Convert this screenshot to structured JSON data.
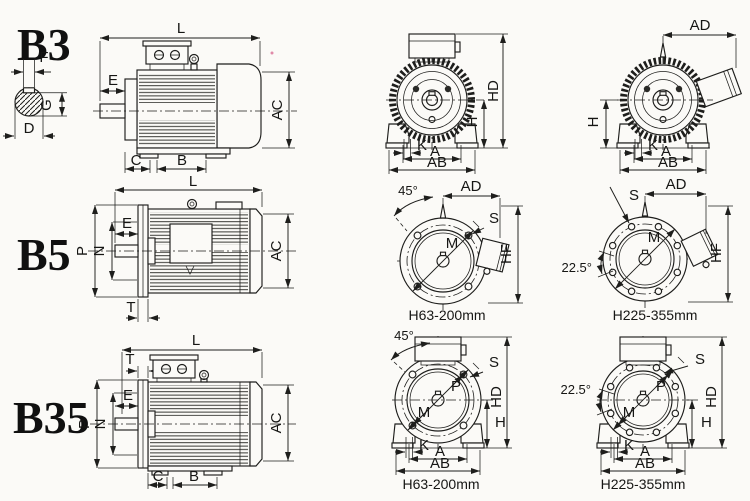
{
  "page": {
    "description": "IEC motor mounting arrangement dimension drawings",
    "background": "#fbfaf7",
    "ink": "#1e1e1c"
  },
  "rows": [
    {
      "mount_code": "B3",
      "shaft_section": {
        "key_width": "F",
        "key_depth": "G",
        "shaft_dia": "D"
      },
      "side_view": {
        "length": "L",
        "shaft_ext": "E",
        "frame_dia": "AC",
        "foot_front": "C",
        "foot_spacing": "B"
      },
      "front_view_1": {
        "total_height": "HD",
        "shaft_height": "H",
        "foot_slot": "K",
        "foot_span": "A",
        "foot_width": "AB"
      },
      "front_view_2": {
        "box_width": "AD",
        "shaft_height": "H",
        "foot_slot": "K",
        "foot_span": "A",
        "foot_width": "AB"
      }
    },
    {
      "mount_code": "B5",
      "side_view": {
        "length": "L",
        "flange_dia": "P",
        "spigot_dia": "N",
        "shaft_ext": "E",
        "flange_thk": "T",
        "frame_dia": "AC"
      },
      "flange_view_1": {
        "hole_angle": "45°",
        "box_width": "AD",
        "bolt_hole": "S",
        "bolt_circle": "M",
        "flange_height": "HF",
        "caption": "H63-200mm"
      },
      "flange_view_2": {
        "box_width": "AD",
        "bolt_hole": "S",
        "hole_angle": "22.5°",
        "bolt_circle": "M",
        "flange_height": "HF",
        "caption": "H225-355mm"
      }
    },
    {
      "mount_code": "B35",
      "side_view": {
        "length": "L",
        "flange_thk": "T",
        "shaft_ext": "E",
        "flange_dia": "P",
        "spigot_dia": "N",
        "foot_front": "C",
        "foot_spacing": "B",
        "frame_dia": "AC"
      },
      "front_view_1": {
        "hole_angle": "45°",
        "bolt_hole": "S",
        "flange_dia": "P",
        "bolt_circle": "M",
        "total_height": "HD",
        "shaft_height": "H",
        "foot_slot": "K",
        "foot_span": "A",
        "foot_width": "AB",
        "caption": "H63-200mm"
      },
      "front_view_2": {
        "hole_angle": "22.5°",
        "bolt_hole": "S",
        "flange_dia": "P",
        "bolt_circle": "M",
        "total_height": "HD",
        "shaft_height": "H",
        "foot_slot": "K",
        "foot_span": "A",
        "foot_width": "AB",
        "caption": "H225-355mm"
      }
    }
  ]
}
